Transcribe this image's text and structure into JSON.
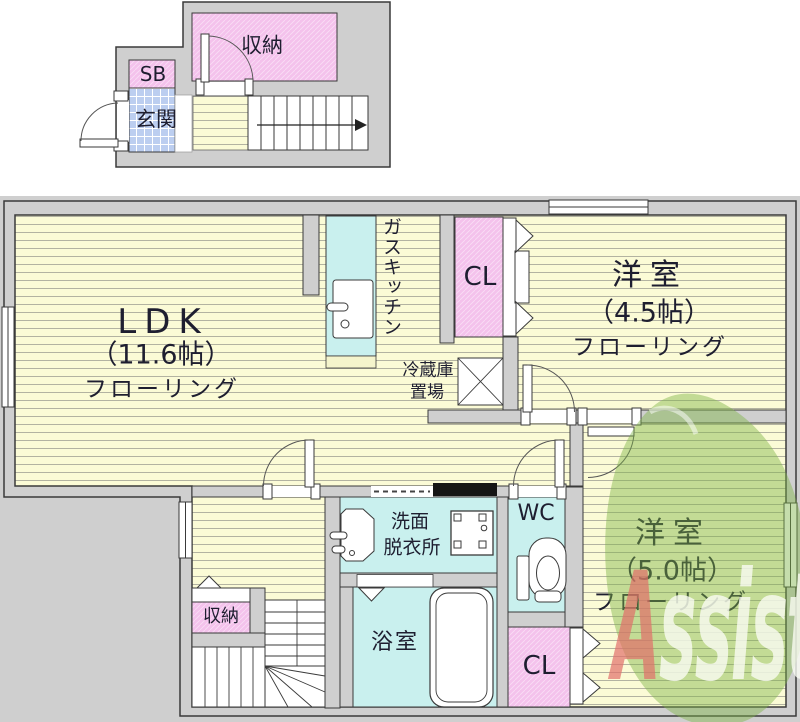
{
  "mini_plan": {
    "storage_label": "収納",
    "shoebox_label": "SB",
    "entrance_label": "玄関"
  },
  "main_plan": {
    "ldk": {
      "name": "LDK",
      "size": "（11.6帖）",
      "floor": "フローリング"
    },
    "kitchen_label": "ガスキッチン",
    "closet_upper_label": "CL",
    "room_4_5": {
      "name": "洋室",
      "size": "（4.5帖）",
      "floor": "フローリング"
    },
    "fridge_label": {
      "line1": "冷蔵庫",
      "line2": "置場"
    },
    "washroom_label": {
      "line1": "洗面",
      "line2": "脱衣所"
    },
    "wc_label": "WC",
    "bath_label": "浴室",
    "storage_label": "収納",
    "closet_lower_label": "CL",
    "room_5_0": {
      "name": "洋室",
      "size": "（5.0帖）",
      "floor": "フローリング"
    }
  },
  "watermark": {
    "letter_a": "A",
    "rest": "ssist"
  },
  "colors": {
    "floor_yellow": "#fbfbd6",
    "room_pink": "#f4c2ec",
    "room_cyan": "#c9f0ee",
    "entrance_blue": "#bccef0",
    "wall_gray": "#cfcfcf",
    "outline": "#3a3a3a",
    "label_ink": "#1e1e30",
    "logo_green": "#7fb446",
    "logo_red": "rgba(224,110,105,0.82)",
    "logo_text": "#fcfdf5"
  }
}
